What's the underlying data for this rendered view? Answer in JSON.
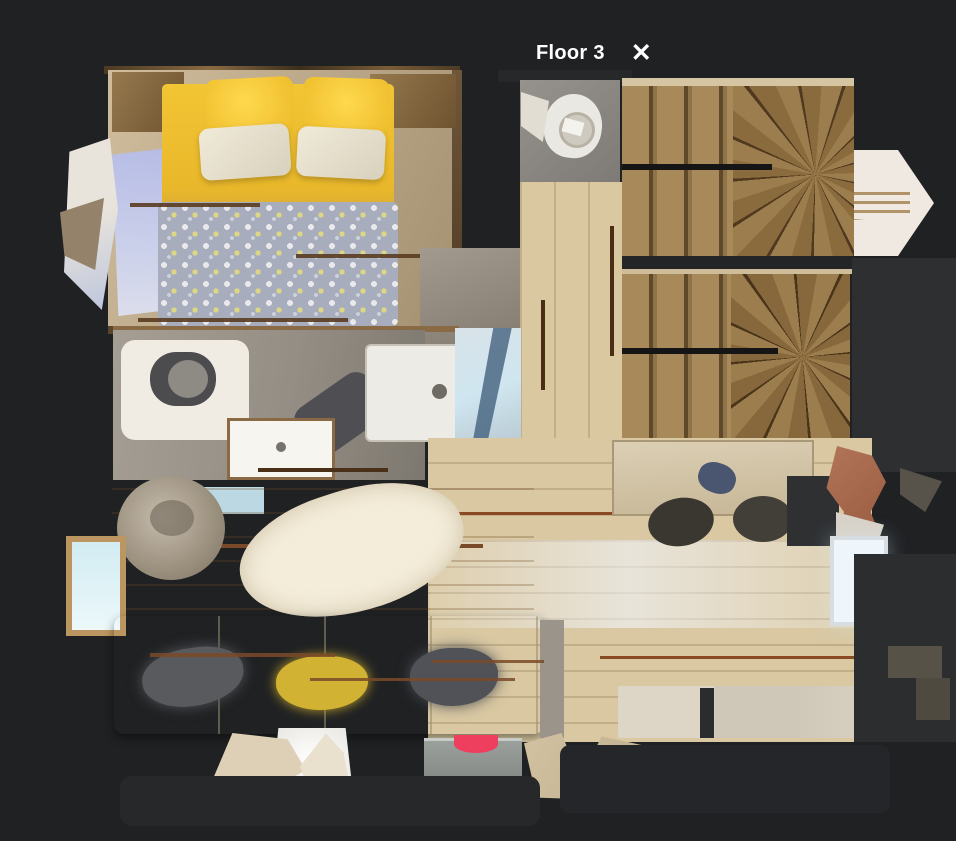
{
  "header": {
    "title": "Floor 3",
    "close_glyph": "✕"
  },
  "colors": {
    "background": "#1f2123",
    "text": "#ffffff",
    "bed_yellow": "#f2c535",
    "blanket_gray": "#a8adbd",
    "stair_wood": "#8a6f45",
    "hall_wood": "#d9c8a0",
    "floor_pale_oak": "#d9c8a2",
    "floor_golden_oak": "#c9a265",
    "bath_gray": "#958e85",
    "sofa_cream": "#f3eee2",
    "rug_white": "#f4edda",
    "window_blue": "#cfe6f0",
    "accent_red": "#ee3f5e"
  }
}
